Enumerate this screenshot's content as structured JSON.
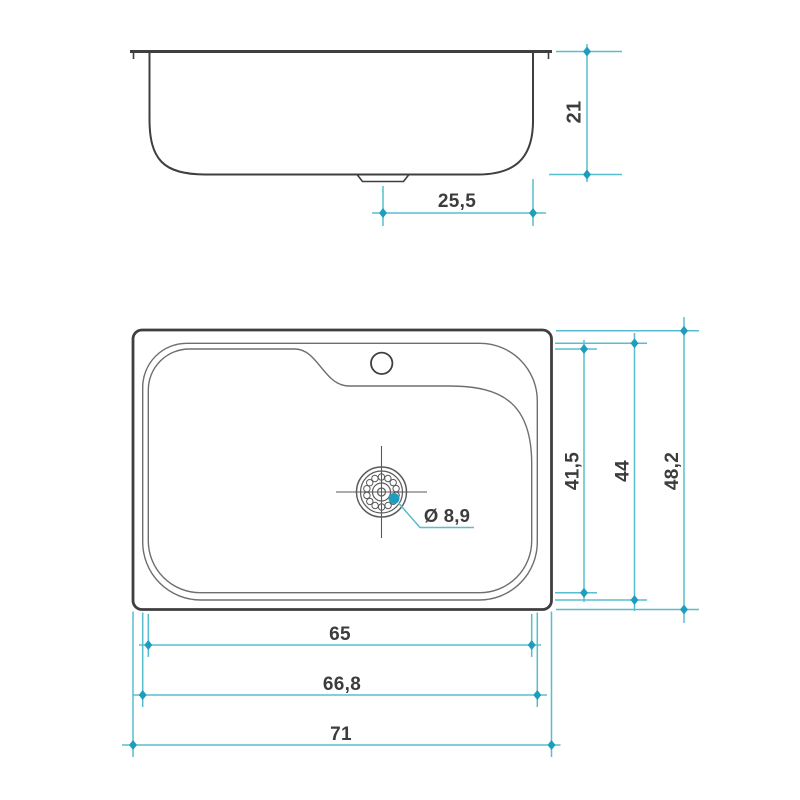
{
  "dimensions": {
    "bowl_height": "21",
    "drain_to_edge": "25,5",
    "basin_inner_width": "41,5",
    "basin_outer_width": "44",
    "overall_depth": "48,2",
    "basin_inner_length": "65",
    "basin_outer_length": "66,8",
    "overall_length": "71",
    "drain_diameter": "Ø 8,9"
  },
  "colors": {
    "background": "#ffffff",
    "outline_strong": "#3f3f3f",
    "outline_light": "#6e6e6e",
    "drain_line": "#5a5a5a",
    "dimension_line": "#58bdcd",
    "dimension_marker": "#1d9ebe",
    "label_text": "#3c3c3c"
  }
}
